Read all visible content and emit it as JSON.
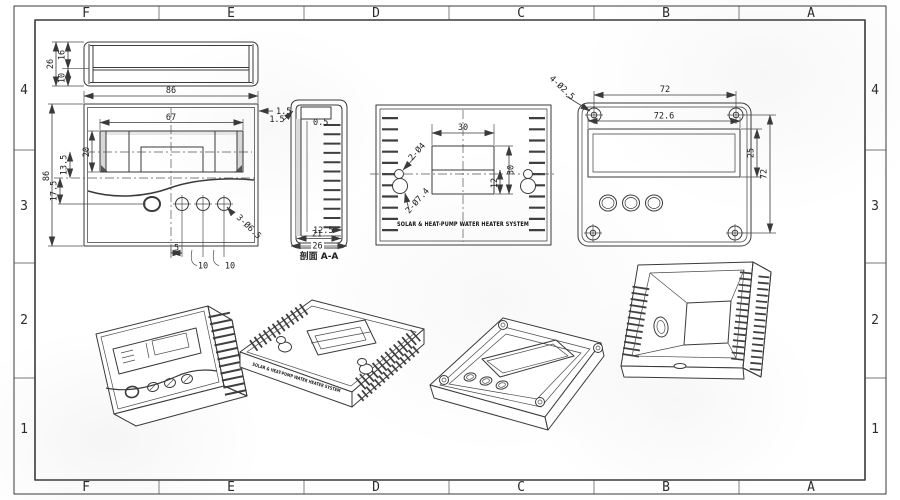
{
  "drawing": {
    "border": {
      "columns": [
        "F",
        "E",
        "D",
        "C",
        "B",
        "A"
      ],
      "rows": [
        "4",
        "3",
        "2",
        "1"
      ]
    },
    "top_view": {
      "dims": {
        "total_h": "26",
        "upper": "16",
        "lower": "10"
      }
    },
    "front_view": {
      "dims": {
        "width": "86",
        "height": "86",
        "window_w": "67",
        "window_h": "20",
        "mid": "13.5",
        "lower": "17.5",
        "wall": "1.5",
        "buttons": "3-Ø6.5",
        "btn_offset": "5",
        "pitch_a": "10",
        "pitch_b": "10"
      }
    },
    "section_view": {
      "label": "剖面 A-A",
      "dims": {
        "wall": "1.5",
        "lip": "0.5",
        "depth": "12.5",
        "inner_w": "21",
        "outer_w": "26"
      }
    },
    "rear_view": {
      "title": "SOLAR & HEAT-PUMP WATER HEATER SYSTEM",
      "dims": {
        "slot_w": "30",
        "slot_h": "30",
        "offset": "12",
        "keyhole_small": "2-Ø4",
        "keyhole_large": "2-Ø7.4"
      }
    },
    "mount_view": {
      "dims": {
        "hole_span_h": "72",
        "width": "72.6",
        "window_h": "25",
        "hole_span_v": "72",
        "holes": "4-Ø2.5"
      }
    },
    "colors": {
      "line": "#3a3a3a",
      "paper": "#ffffff"
    }
  }
}
